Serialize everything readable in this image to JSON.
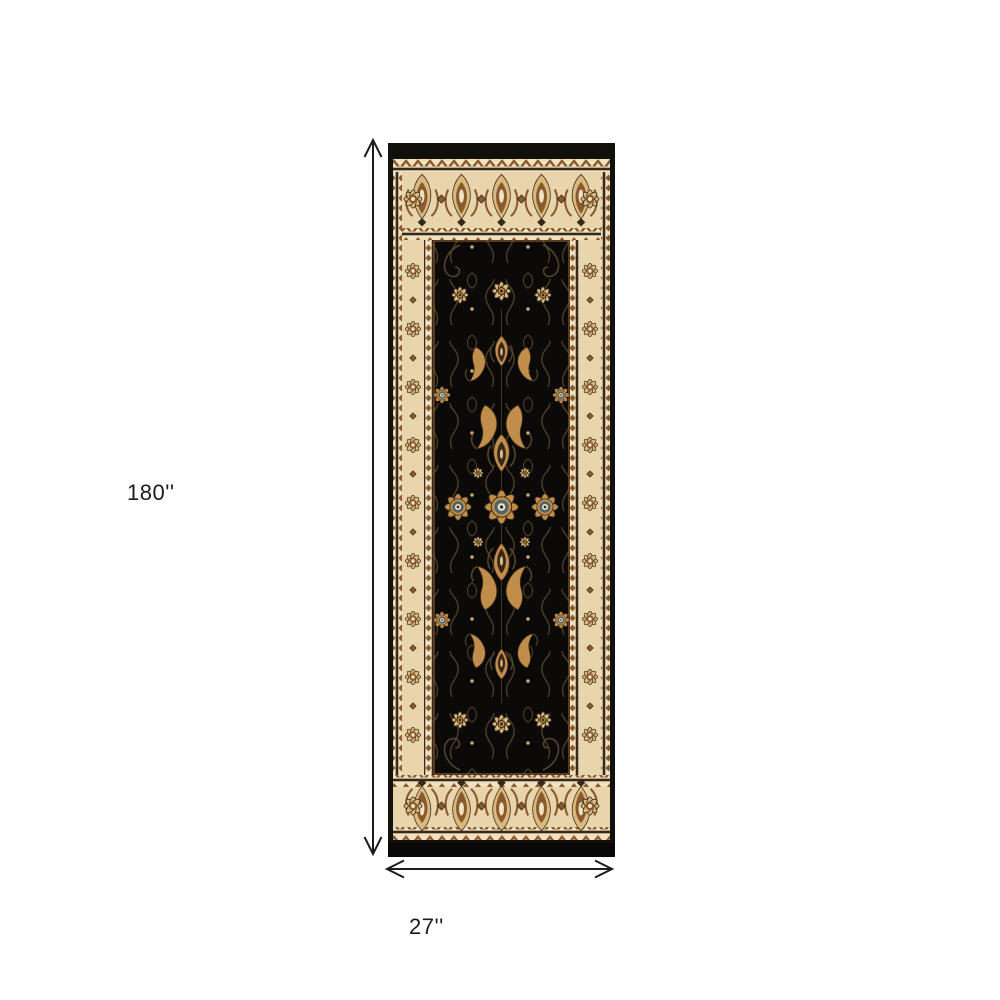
{
  "figure": {
    "type": "product-dimension-image",
    "subject": "Black and ivory traditional oriental runner rug with ornate floral borders, shown flat on a white background with measurement arrows",
    "dimensions": {
      "height_label": "180''",
      "width_label": "27''"
    }
  },
  "palette": {
    "background": "#ffffff",
    "annotation": "#1c1c1c",
    "rug_black": "#12100c",
    "rug_field": "#0c0a08",
    "border_cream": "#e8d5ab",
    "border_cream_light": "#f0e2c0",
    "motif_brown": "#8a5a2e",
    "motif_dark": "#38281a",
    "motif_gold": "#c08d4a",
    "motif_tan": "#d9b97e",
    "accent_teal": "#4a666c",
    "vine": "#57462e"
  }
}
